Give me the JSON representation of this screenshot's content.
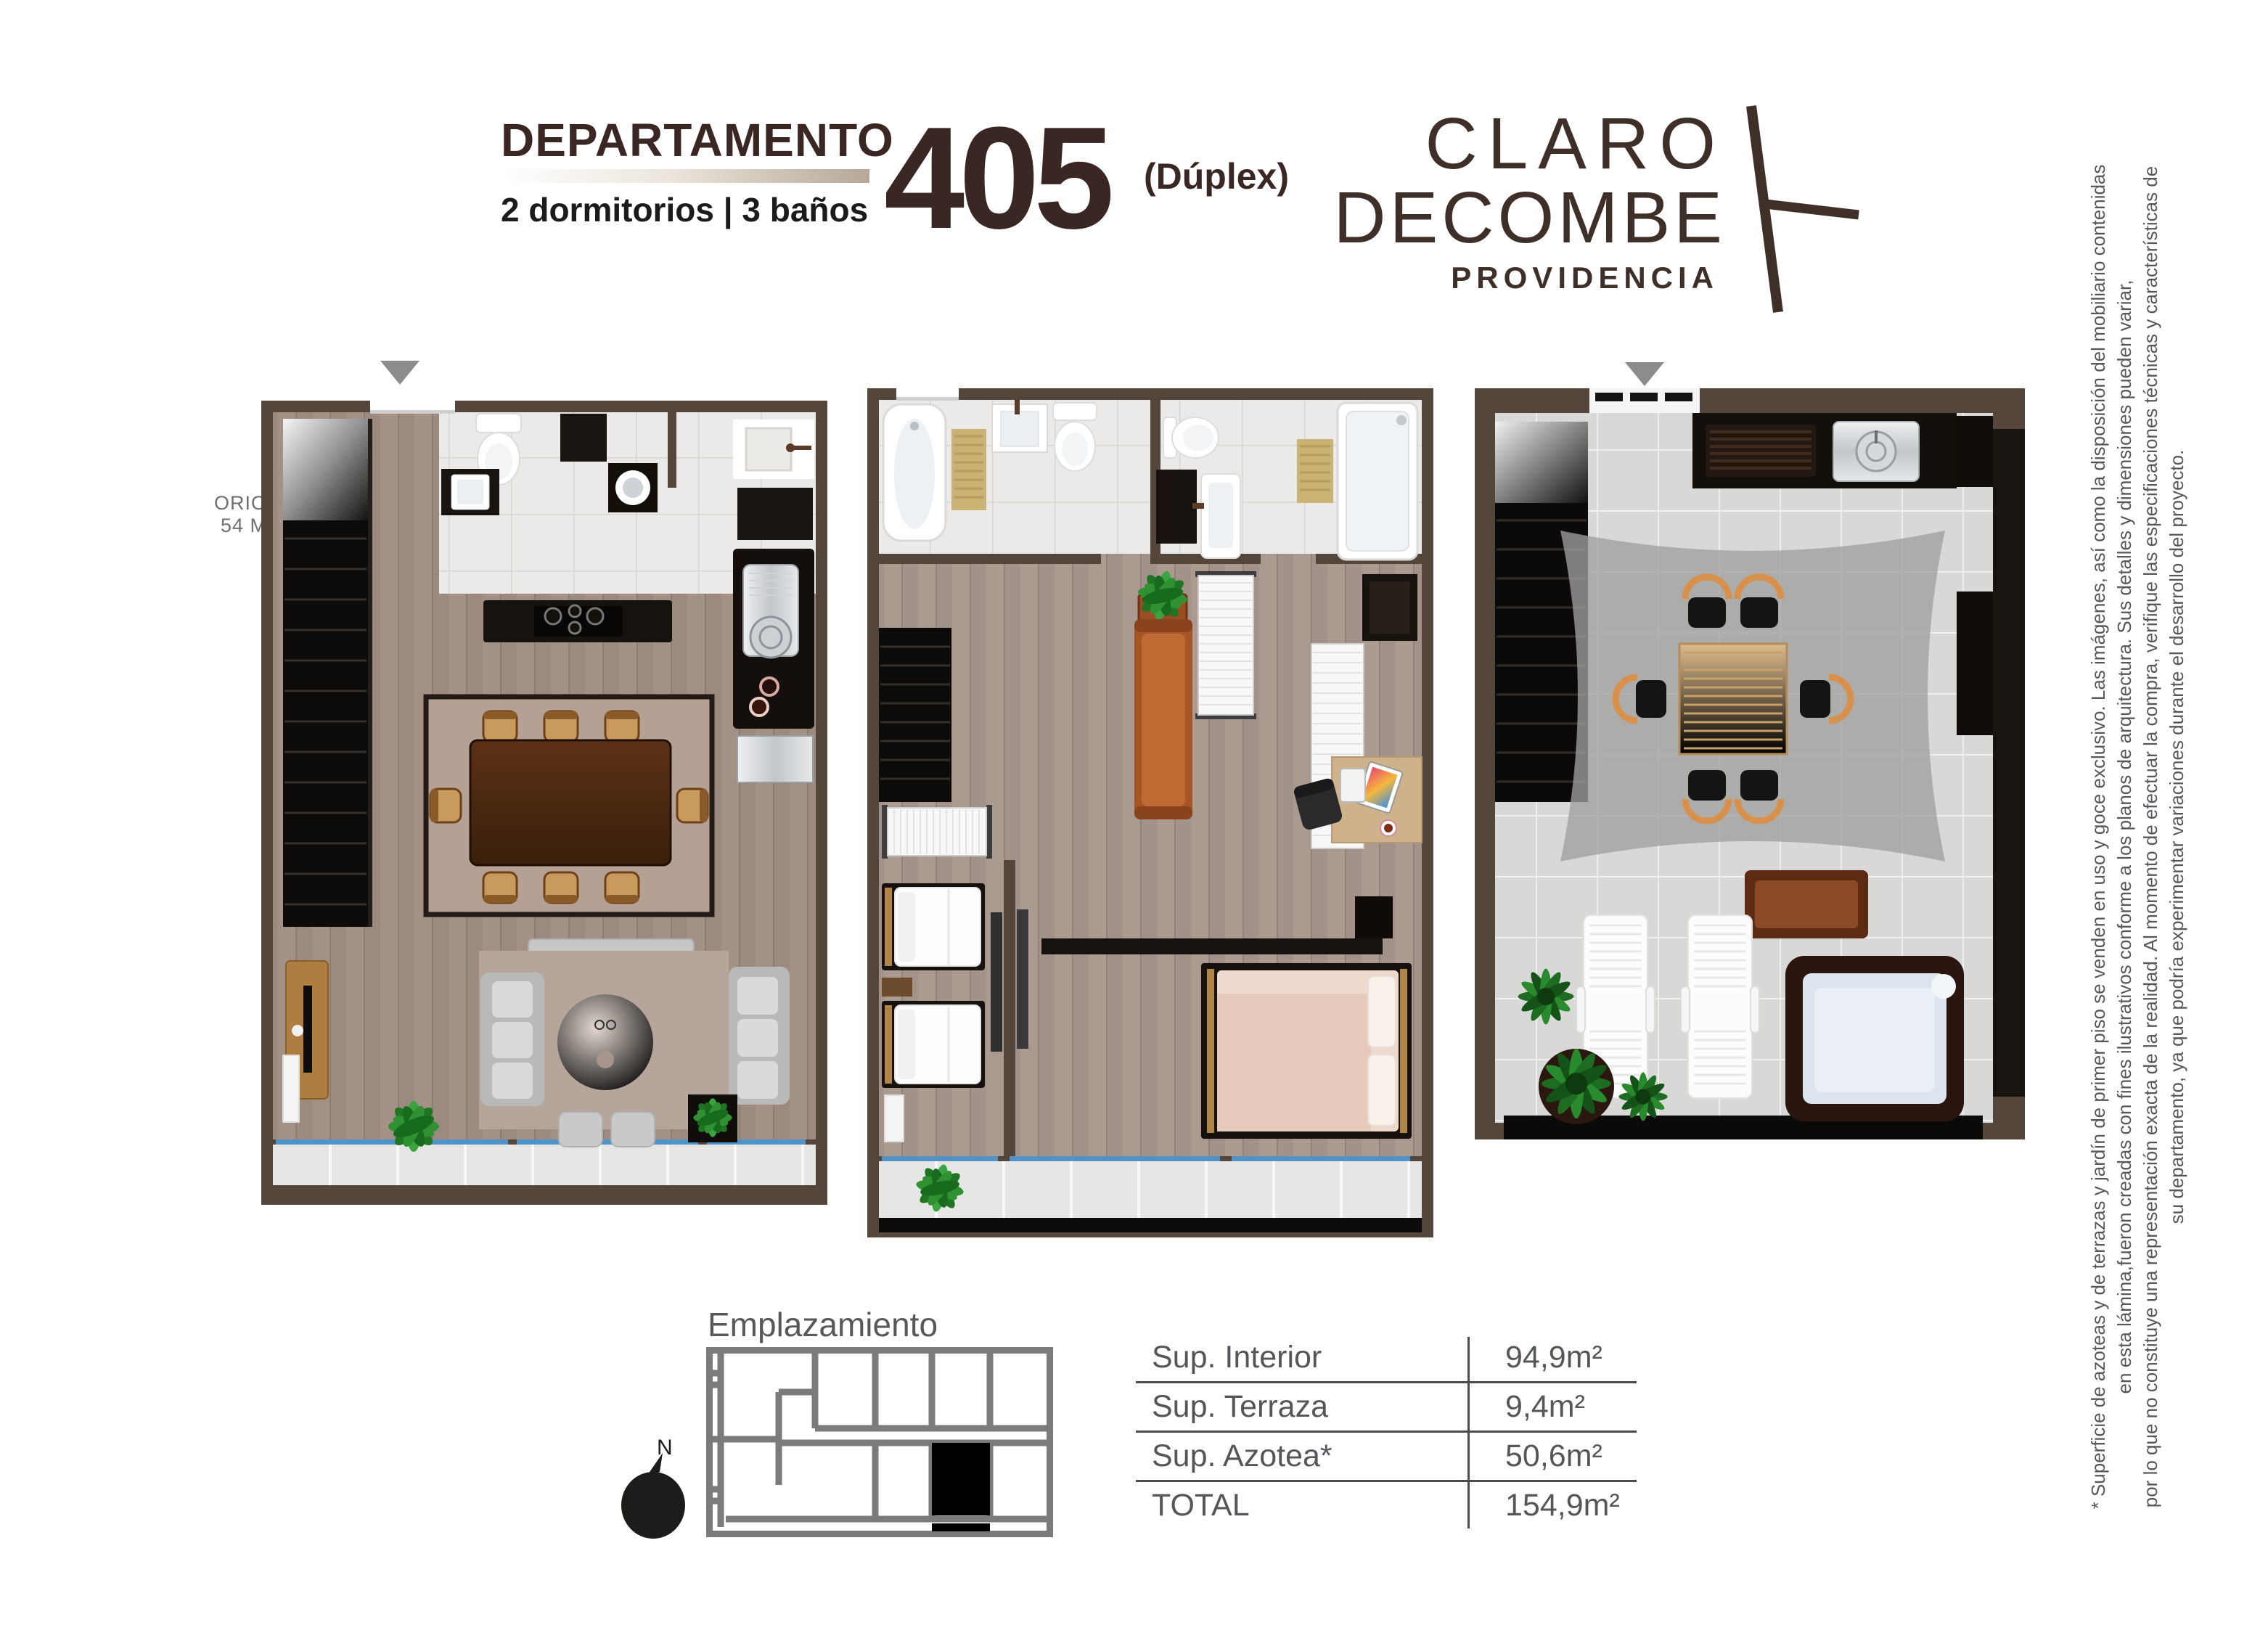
{
  "header": {
    "title": "DEPARTAMENTO",
    "subtitle": "2 dormitorios | 3 baños",
    "unit_number": "405",
    "unit_type": "(Dúplex)"
  },
  "logo": {
    "line1": "CLARO",
    "line2": "DECOMBE",
    "line3": "PROVIDENCIA"
  },
  "disclaimer": {
    "line1": "* Superficie de azoteas y de terrazas y jardín de primer piso se venden en uso y goce exclusivo. Las imágenes, así como la disposición del mobiliario contenidas",
    "line2": "en esta lámina,fueron creadas con fines ilustrativos conforme a los planos de arquitectura. Sus detalles y dimensiones pueden variar,",
    "line3": "por lo que no constituye una representación exacta de la realidad. Al momento de efectuar la compra, verifique las especificaciones técnicas y características de",
    "line4": "su departamento, ya que podría experimentar variaciones durante el desarrollo del proyecto."
  },
  "site_plan": {
    "label": "Emplazamiento",
    "compass_label": "N"
  },
  "areas_table": {
    "rows": [
      {
        "label": "Sup. Interior",
        "value": "94,9m²"
      },
      {
        "label": "Sup. Terraza",
        "value": "9,4m²"
      },
      {
        "label": "Sup. Azotea*",
        "value": "50,6m²"
      },
      {
        "label": "TOTAL",
        "value": "154,9m²"
      }
    ]
  },
  "floor_plans": {
    "clipped_label_line1": "ORIO",
    "clipped_label_line2": "54 M"
  },
  "icons": [
    "entry-arrow-icon",
    "north-compass-icon",
    "logo-mark-icon"
  ],
  "palette": {
    "title_brown": "#3a2723",
    "logo_brown": "#3e3029",
    "wall_brown": "#55463c",
    "floor_wood": "#a39186",
    "bath_tile": "#eceae8",
    "terrace_tile": "#e6e6e4",
    "roof_tile": "#d8d8d6",
    "stair_black": "#0d0b09",
    "railing_blue": "#4f93c8",
    "table_line_gray": "#4b4c4e",
    "text_gray": "#55565a",
    "site_plan_gray": "#7b7b7b",
    "sofa_gray": "#b9b9b9",
    "sofa_sienna": "#b05c2e",
    "chair_tan": "#c89a5e",
    "plant_green": "#2f9132"
  }
}
